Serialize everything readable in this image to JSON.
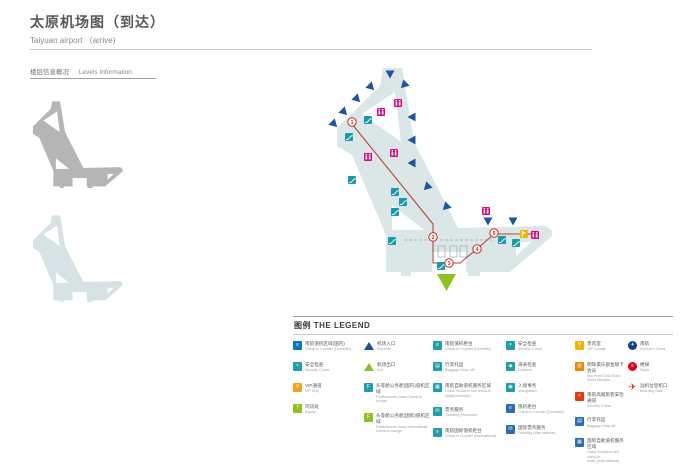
{
  "header": {
    "title_zh": "太原机场图（到达）",
    "title_en": "Taiyuan airport （arrive)"
  },
  "levels": {
    "label_zh": "楼层信息概况",
    "label_en": "Levels Information",
    "floors": [
      {
        "name": "upper-level"
      },
      {
        "name": "arrival-level"
      }
    ]
  },
  "map": {
    "colors": {
      "body": "#dbe6e7",
      "gate": "#1b55a5",
      "exit": "#8dc21f",
      "restroom": "#e4007f",
      "escalator": "#189aad",
      "vip": "#f0b400",
      "route": "#b5453c",
      "floor_upper": "#b5b5b5",
      "floor_lower": "#d6e2e3"
    },
    "gates": [
      {
        "x": 390,
        "y": 74,
        "rot": 0
      },
      {
        "x": 371,
        "y": 87,
        "rot": -45
      },
      {
        "x": 357,
        "y": 99,
        "rot": -45
      },
      {
        "x": 344,
        "y": 112,
        "rot": -45
      },
      {
        "x": 334,
        "y": 124,
        "rot": -45
      },
      {
        "x": 404,
        "y": 85,
        "rot": 45
      },
      {
        "x": 412,
        "y": 117,
        "rot": 90
      },
      {
        "x": 412,
        "y": 140,
        "rot": 90
      },
      {
        "x": 412,
        "y": 163,
        "rot": 90
      },
      {
        "x": 427,
        "y": 187,
        "rot": 45
      },
      {
        "x": 446,
        "y": 207,
        "rot": 45
      },
      {
        "x": 488,
        "y": 221,
        "rot": 0
      },
      {
        "x": 513,
        "y": 221,
        "rot": 0
      }
    ],
    "restrooms": [
      {
        "x": 398,
        "y": 103
      },
      {
        "x": 381,
        "y": 112
      },
      {
        "x": 394,
        "y": 153
      },
      {
        "x": 368,
        "y": 157
      },
      {
        "x": 486,
        "y": 211
      },
      {
        "x": 535,
        "y": 235
      }
    ],
    "escalators": [
      {
        "x": 368,
        "y": 120
      },
      {
        "x": 349,
        "y": 137
      },
      {
        "x": 352,
        "y": 180
      },
      {
        "x": 395,
        "y": 192
      },
      {
        "x": 403,
        "y": 202
      },
      {
        "x": 395,
        "y": 212
      },
      {
        "x": 392,
        "y": 241
      },
      {
        "x": 502,
        "y": 240
      },
      {
        "x": 516,
        "y": 243
      },
      {
        "x": 441,
        "y": 266
      }
    ],
    "vip": {
      "x": 524,
      "y": 234
    },
    "exit": {
      "x": 446,
      "y": 282
    },
    "route": {
      "path": "352,124 433,224 433,263 460,263 477,249 494,234 532,234",
      "stops": [
        {
          "n": "1",
          "x": 352,
          "y": 122
        },
        {
          "n": "2",
          "x": 433,
          "y": 237
        },
        {
          "n": "3",
          "x": 449,
          "y": 263
        },
        {
          "n": "4",
          "x": 477,
          "y": 249
        },
        {
          "n": "5",
          "x": 494,
          "y": 233
        }
      ]
    }
  },
  "legend": {
    "title": "图例  THE LEGEND",
    "columns": [
      {
        "items": [
          {
            "zh": "南航值机区域(国内)",
            "en": "Check-in Counter  (Domestic)",
            "icon": "square",
            "color": "#0079c1",
            "glyph": "≡"
          },
          {
            "zh": "安全检查",
            "en": "Security Check",
            "icon": "square",
            "color": "#1d9fae",
            "glyph": "×"
          },
          {
            "zh": "VIP通道",
            "en": "VIP Only",
            "icon": "square",
            "color": "#f5a31c",
            "glyph": "V"
          },
          {
            "zh": "问讯处",
            "en": "Inquiry",
            "icon": "square",
            "color": "#8dc21f",
            "glyph": "?"
          }
        ]
      },
      {
        "items": [
          {
            "zh": "机场入口",
            "en": "Entrance",
            "icon": "triangle",
            "color": "#1c4f9c",
            "glyph": ""
          },
          {
            "zh": "机场出口",
            "en": "Exit",
            "icon": "triangle",
            "color": "#8dc21f",
            "glyph": ""
          },
          {
            "zh": "头等舱公务舱(国内)值机区域",
            "en": "Fst/Business Class Check-in lounge",
            "icon": "square",
            "color": "#1d9fae",
            "glyph": "F"
          },
          {
            "zh": "头等舱公务舱(国际)值机区域",
            "en": "Fst/Business Class International Check-in lounge",
            "icon": "square",
            "color": "#8dc21f",
            "glyph": "F"
          }
        ]
      },
      {
        "items": [
          {
            "zh": "南航值机柜台",
            "en": "Check-in Counter  (Domestic)",
            "icon": "square",
            "color": "#1d9fae",
            "glyph": "≡"
          },
          {
            "zh": "行李托运",
            "en": "Baggage Drop- off",
            "icon": "square",
            "color": "#1d9fae",
            "glyph": "▤"
          },
          {
            "zh": "南航自助值机服务区域",
            "en": "China Southern self check-in kiosk(Domestic)",
            "icon": "square",
            "color": "#1d9fae",
            "glyph": "▦"
          },
          {
            "zh": "票务服务",
            "en": "Ticketing  (Domestic)",
            "icon": "square",
            "color": "#1d9fae",
            "glyph": "✉"
          },
          {
            "zh": "南航国际值机柜台",
            "en": "Check-in Counter  (International)",
            "icon": "square",
            "color": "#1d9fae",
            "glyph": "≡"
          }
        ]
      },
      {
        "items": [
          {
            "zh": "安全检查",
            "en": "Security Check",
            "icon": "square",
            "color": "#1d9fae",
            "glyph": "×"
          },
          {
            "zh": "海关检查",
            "en": "Customs",
            "icon": "square",
            "color": "#1d9fae",
            "glyph": "◆"
          },
          {
            "zh": "入境事务",
            "en": "Immigration",
            "icon": "square",
            "color": "#1d9fae",
            "glyph": "◉"
          },
          {
            "zh": "值机柜台",
            "en": "Check-in Counter  (Domestic)",
            "icon": "square",
            "color": "#2a6db5",
            "glyph": "≡"
          },
          {
            "zh": "国际票务服务",
            "en": "Ticketing  (International)",
            "icon": "square",
            "color": "#2a6db5",
            "glyph": "✉"
          }
        ]
      },
      {
        "items": [
          {
            "zh": "贵宾室",
            "en": "VIP Lounge",
            "icon": "square",
            "color": "#f0b400",
            "glyph": "V"
          },
          {
            "zh": "明珠俱乐部金银卡会员",
            "en": "Sky Pearl Club Gold/ Silver Member",
            "icon": "square",
            "color": "#f08300",
            "glyph": "▥"
          },
          {
            "zh": "南航高端旅客安检通道",
            "en": "Security Check",
            "icon": "square",
            "color": "#e8380d",
            "glyph": "×"
          },
          {
            "zh": "行李托运",
            "en": "Baggage Drop-off",
            "icon": "square",
            "color": "#2a6db5",
            "glyph": "▤"
          },
          {
            "zh": "国际自助值机服务区域",
            "en": "China Southern self check-in kiosk_(International)",
            "icon": "square",
            "color": "#2a6db5",
            "glyph": "▦"
          }
        ]
      },
      {
        "items": [
          {
            "zh": "南航",
            "en": "Southern China",
            "icon": "circle",
            "color": "#123f8f",
            "glyph": "✈"
          },
          {
            "zh": "楼梯",
            "en": "Steps",
            "icon": "circle",
            "color": "#e60012",
            "glyph": "≡"
          },
          {
            "zh": "远机位登机口",
            "en": "Boarding Gate",
            "icon": "plane",
            "color": "#cf2e24",
            "glyph": "✈"
          }
        ]
      }
    ]
  }
}
